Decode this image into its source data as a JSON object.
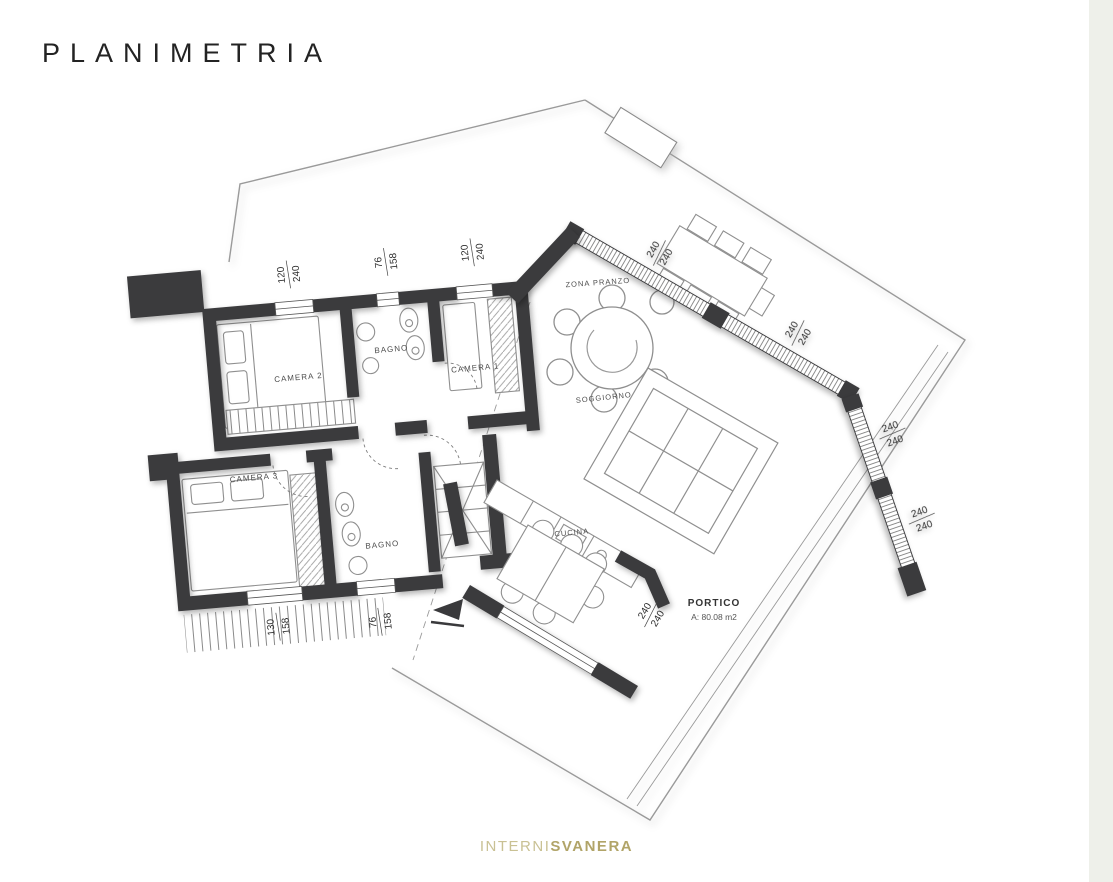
{
  "page": {
    "title": "PLANIMETRIA"
  },
  "footer": {
    "brand_light": "INTERNI",
    "brand_bold": "SVANERA"
  },
  "plan": {
    "rooms": {
      "camera2": "CAMERA 2",
      "bagno1": "BAGNO",
      "camera1": "CAMERA 1",
      "camera3": "CAMERA 3",
      "bagno2": "BAGNO",
      "zona_pranzo": "ZONA PRANZO",
      "soggiorno": "SOGGIORNO",
      "cucina": "CUCINA",
      "portico": "PORTICO",
      "portico_area": "A: 80.08 m2"
    },
    "dimensions": [
      {
        "a": "120",
        "b": "240"
      },
      {
        "a": "76",
        "b": "158"
      },
      {
        "a": "120",
        "b": "240"
      },
      {
        "a": "240",
        "b": "240"
      },
      {
        "a": "240",
        "b": "240"
      },
      {
        "a": "240",
        "b": "240"
      },
      {
        "a": "240",
        "b": "240"
      },
      {
        "a": "240",
        "b": "240"
      },
      {
        "a": "130",
        "b": "158"
      },
      {
        "a": "76",
        "b": "158"
      }
    ],
    "colors": {
      "wall": "#3a3a3c",
      "line": "#8f8f8f",
      "brand_gold": "#b1a468"
    }
  }
}
